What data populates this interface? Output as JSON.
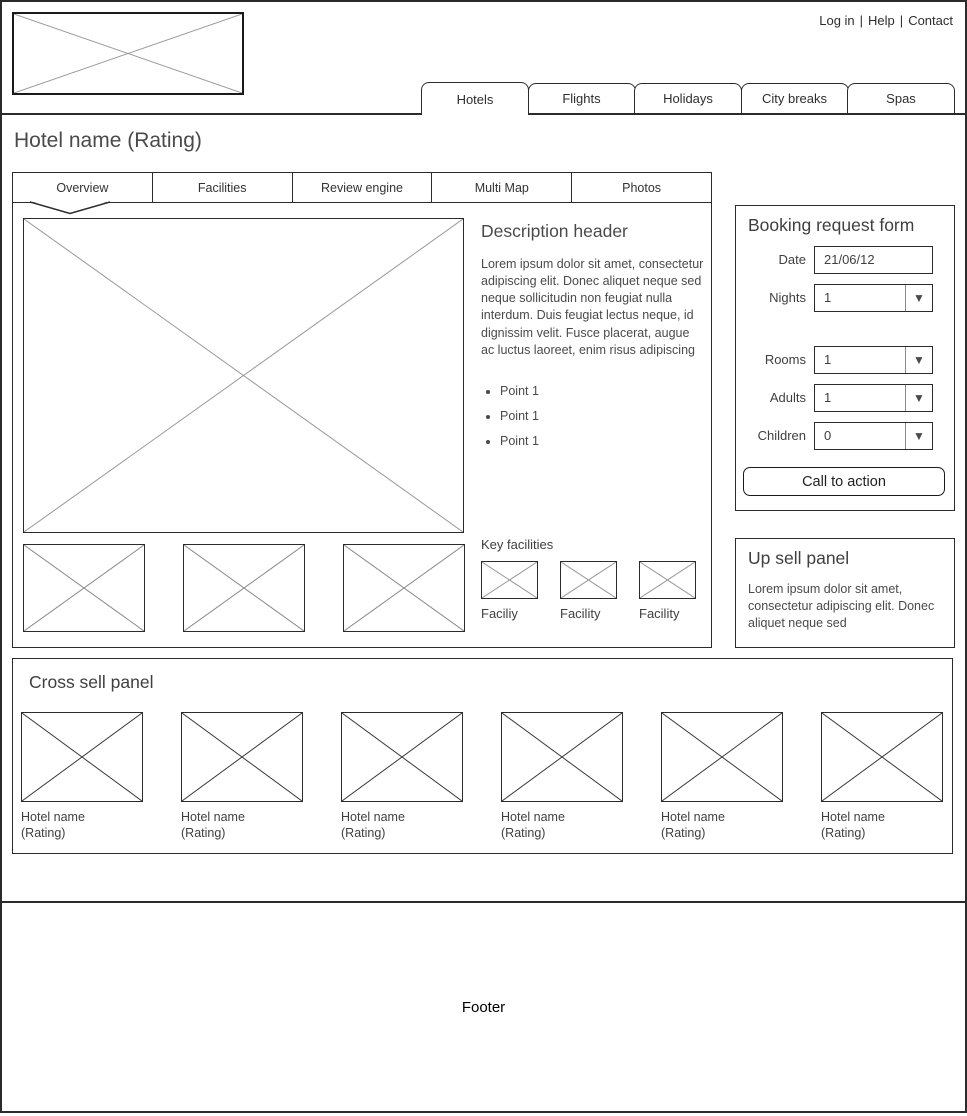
{
  "header": {
    "links": [
      {
        "label": "Log in"
      },
      {
        "label": "Help"
      },
      {
        "label": "Contact"
      }
    ],
    "separator": "|",
    "tabs": [
      {
        "label": "Hotels",
        "active": true
      },
      {
        "label": "Flights",
        "active": false
      },
      {
        "label": "Holidays",
        "active": false
      },
      {
        "label": "City breaks",
        "active": false
      },
      {
        "label": "Spas",
        "active": false
      }
    ]
  },
  "page_title": "Hotel name (Rating)",
  "subtabs": [
    {
      "label": "Overview",
      "active": true
    },
    {
      "label": "Facilities",
      "active": false
    },
    {
      "label": "Review engine",
      "active": false
    },
    {
      "label": "Multi Map",
      "active": false
    },
    {
      "label": "Photos",
      "active": false
    }
  ],
  "overview": {
    "description_header": "Description header",
    "description_text": "Lorem ipsum dolor sit amet, consectetur adipiscing elit. Donec aliquet neque sed neque sollicitudin non feugiat nulla interdum. Duis feugiat lectus neque, id dignissim velit. Fusce placerat, augue ac luctus laoreet, enim risus adipiscing",
    "bullet_points": [
      "Point 1",
      "Point 1",
      "Point 1"
    ],
    "key_facilities_label": "Key facilities",
    "facilities": [
      {
        "label": "Faciliy"
      },
      {
        "label": "Facility"
      },
      {
        "label": "Facility"
      }
    ]
  },
  "booking_form": {
    "title": "Booking request form",
    "date": {
      "label": "Date",
      "value": "21/06/12"
    },
    "nights": {
      "label": "Nights",
      "value": "1"
    },
    "rooms": {
      "label": "Rooms",
      "value": "1"
    },
    "adults": {
      "label": "Adults",
      "value": "1"
    },
    "children": {
      "label": "Children",
      "value": "0"
    },
    "cta_label": "Call to action"
  },
  "upsell": {
    "title": "Up sell panel",
    "text": "Lorem ipsum dolor sit amet, consectetur adipiscing elit. Donec aliquet neque sed"
  },
  "cross_sell": {
    "title": "Cross sell panel",
    "items": [
      {
        "name": "Hotel name",
        "rating": "(Rating)"
      },
      {
        "name": "Hotel name",
        "rating": "(Rating)"
      },
      {
        "name": "Hotel name",
        "rating": "(Rating)"
      },
      {
        "name": "Hotel name",
        "rating": "(Rating)"
      },
      {
        "name": "Hotel name",
        "rating": "(Rating)"
      },
      {
        "name": "Hotel name",
        "rating": "(Rating)"
      }
    ]
  },
  "footer": {
    "label": "Footer"
  },
  "colors": {
    "border": "#2b2b2b",
    "placeholder_x": "#999999",
    "placeholder_x_dark": "#3a3a3a"
  }
}
